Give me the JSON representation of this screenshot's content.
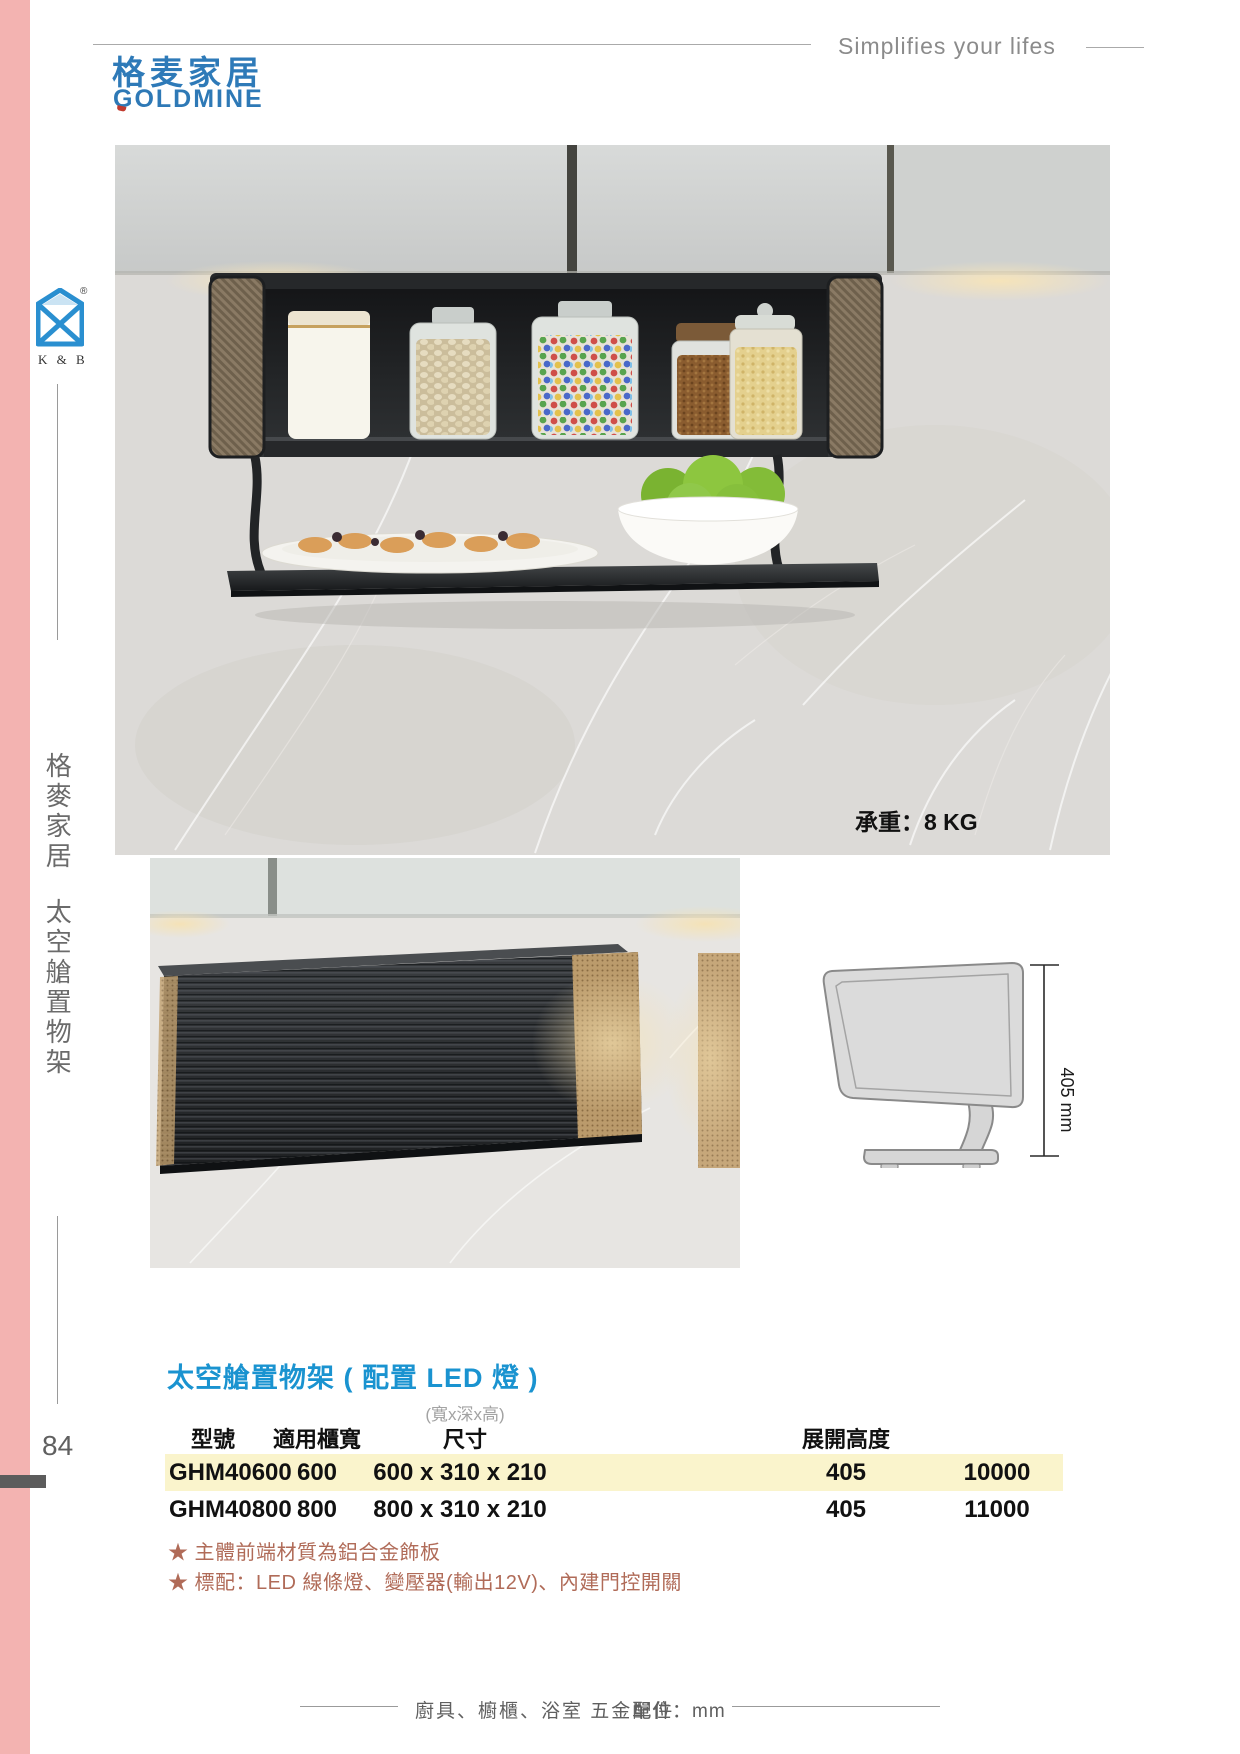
{
  "brand": {
    "name_cn": "格麦家居",
    "name_en": "GOLDMINE",
    "tagline": "Simplifies your lifes",
    "kb_label": "K & B",
    "kb_reg": "®"
  },
  "sidebar": {
    "vertical_title": "格麥家居",
    "vertical_subtitle": "太空艙置物架",
    "page_number": "84"
  },
  "hero": {
    "load_label": "承重：8 KG"
  },
  "diagram": {
    "dimension_label": "405 mm"
  },
  "section": {
    "title": "太空艙置物架 ( 配置 LED 燈 )"
  },
  "table": {
    "size_note": "(寬x深x高)",
    "headers": [
      "型號",
      "適用櫃寬",
      "尺寸",
      "展開高度"
    ],
    "rows": [
      {
        "model": "GHM40600",
        "cabinet_width": "600",
        "size": "600 x 310 x 210",
        "open_height": "405",
        "price": "10000"
      },
      {
        "model": "GHM40800",
        "cabinet_width": "800",
        "size": "800 x 310 x 210",
        "open_height": "405",
        "price": "11000"
      }
    ]
  },
  "notes": [
    "★ 主體前端材質為鋁合金飾板",
    "★ 標配：LED 線條燈、變壓器(輸出12V)、內建門控開關"
  ],
  "footer": {
    "categories": "廚具、櫥櫃、浴室 五金配件",
    "unit": "單位：mm"
  },
  "colors": {
    "accent_blue": "#1a93d0",
    "logo_blue": "#2e7ab8",
    "pink": "#f3b3b1",
    "row_highlight": "#faf4cc",
    "note_color": "#b06b58"
  }
}
